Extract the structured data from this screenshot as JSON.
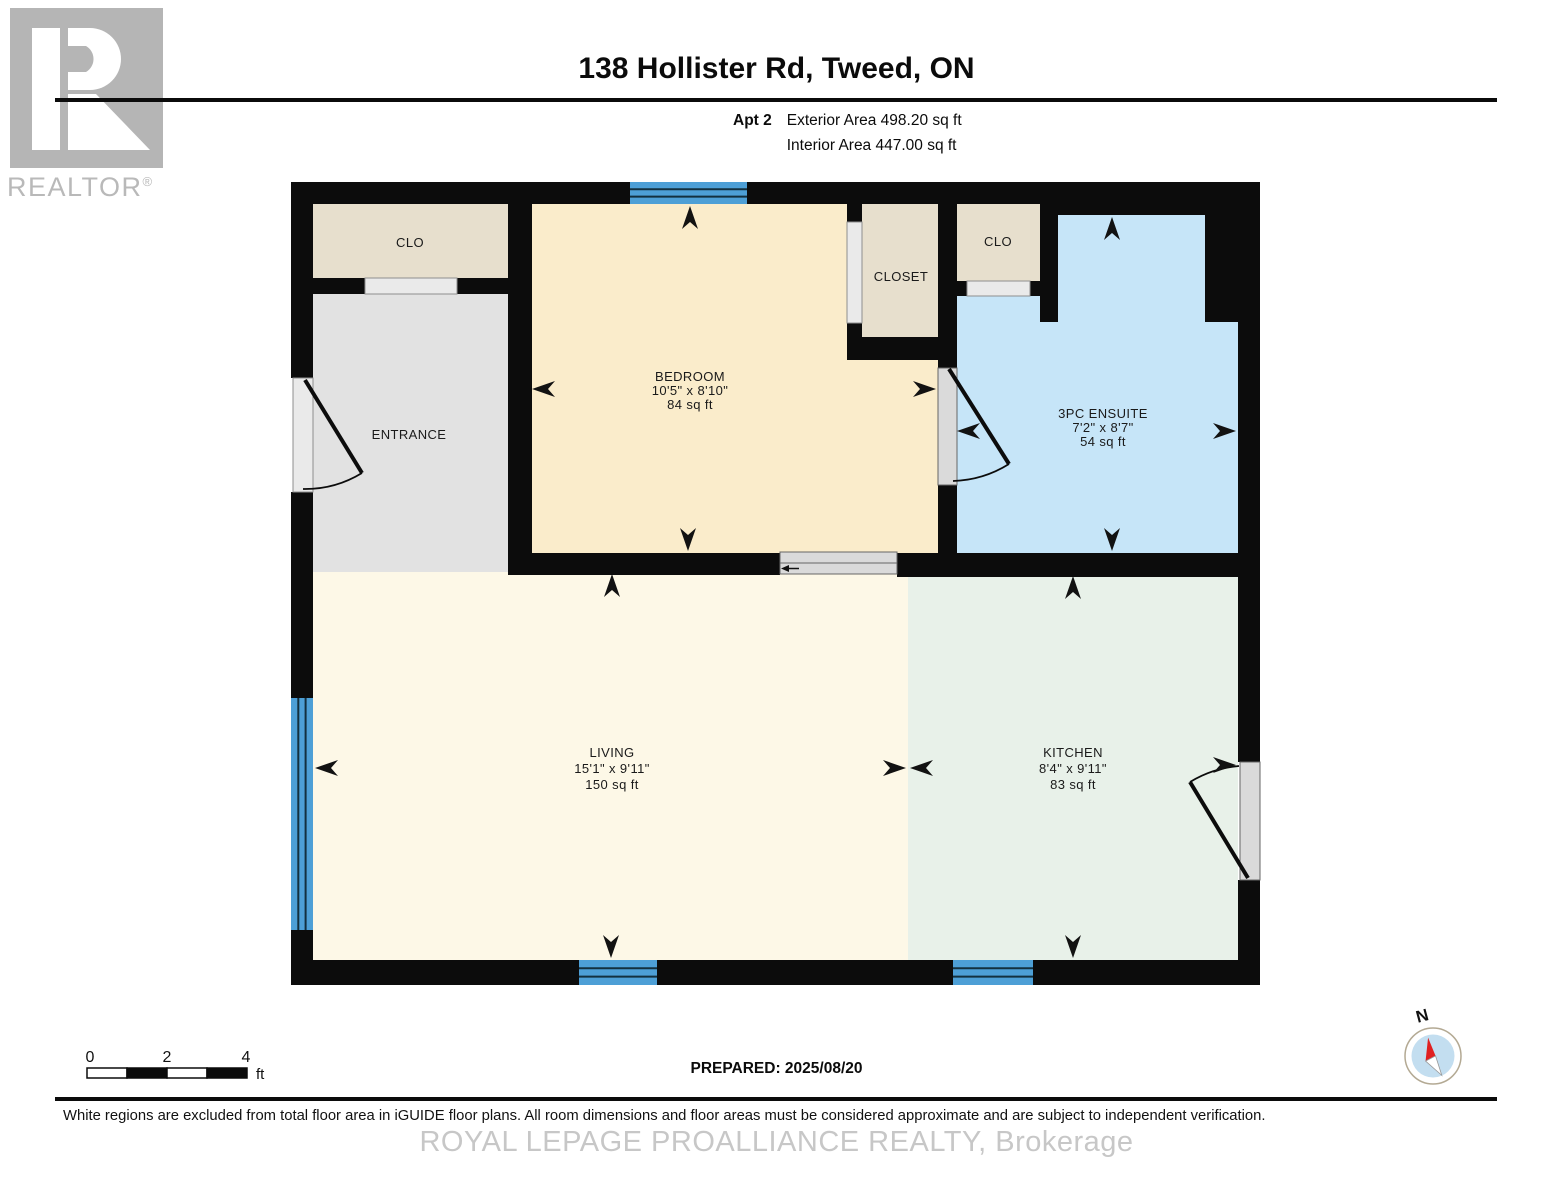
{
  "header": {
    "logo_letter": "R",
    "logo_brand": "REALTOR",
    "logo_reg": "®",
    "title": "138 Hollister Rd, Tweed, ON",
    "unit_label": "Apt 2",
    "exterior_area": "Exterior Area 498.20 sq ft",
    "interior_area": "Interior Area 447.00 sq ft"
  },
  "floorplan": {
    "colors": {
      "wall": "#0c0c0c",
      "bedroom": "#faeccb",
      "living": "#fdf8e7",
      "kitchen": "#e8f1e9",
      "ensuite": "#c6e5f8",
      "closet": "#e7dfcd",
      "entrance": "#e2e2e2",
      "window": "#4d9fd6",
      "door_slab": "#dadada",
      "compass_needle": "#e02020",
      "compass_face": "#c3def0"
    },
    "rooms": {
      "clo1": {
        "label": "CLO"
      },
      "entrance": {
        "label": "ENTRANCE"
      },
      "bedroom": {
        "label": "BEDROOM",
        "dims": "10'5\" x 8'10\"",
        "area": "84 sq ft"
      },
      "closet": {
        "label": "CLOSET"
      },
      "clo2": {
        "label": "CLO"
      },
      "ensuite": {
        "label": "3PC ENSUITE",
        "dims": "7'2\" x 8'7\"",
        "area": "54 sq ft"
      },
      "living": {
        "label": "LIVING",
        "dims": "15'1\" x 9'11\"",
        "area": "150 sq ft"
      },
      "kitchen": {
        "label": "KITCHEN",
        "dims": "8'4\" x 9'11\"",
        "area": "83 sq ft"
      }
    },
    "compass_label": "N"
  },
  "footer": {
    "scale_ticks": [
      "0",
      "2",
      "4"
    ],
    "scale_unit": "ft",
    "prepared": "PREPARED: 2025/08/20",
    "disclaimer": "White regions are excluded from total floor area in iGUIDE floor plans. All room dimensions and floor areas must be considered approximate and are subject to independent verification.",
    "watermark": "ROYAL LEPAGE PROALLIANCE REALTY, Brokerage"
  }
}
